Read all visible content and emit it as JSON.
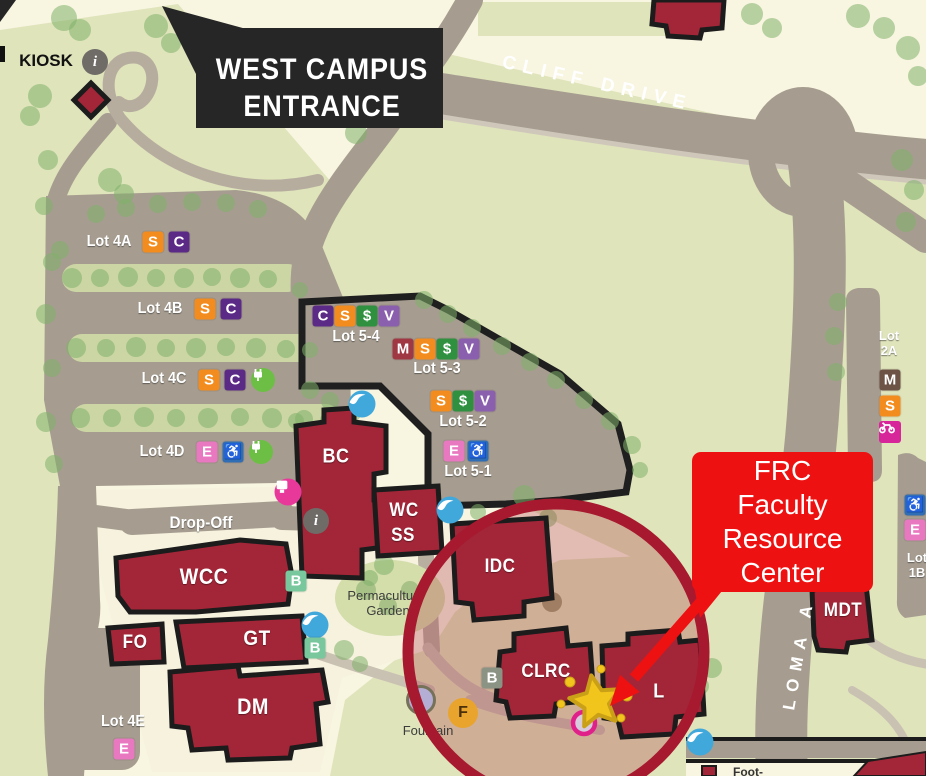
{
  "map": {
    "title_banner": {
      "line1": "WEST CAMPUS",
      "line2": "ENTRANCE"
    },
    "kiosk_label": "KIOSK",
    "roads": {
      "cliff_drive": "CLIFF DRIVE",
      "loma_alta": "LOMA A"
    },
    "labels": {
      "drop_off": "Drop-Off",
      "permaculture_line1": "Permaculture",
      "permaculture_line2": "Garden",
      "fountain": "Fountain"
    },
    "buildings": [
      {
        "id": "bc",
        "label": "BC"
      },
      {
        "id": "wcss",
        "line1": "WC",
        "line2": "SS"
      },
      {
        "id": "idc",
        "label": "IDC"
      },
      {
        "id": "wcc",
        "label": "WCC"
      },
      {
        "id": "fo",
        "label": "FO"
      },
      {
        "id": "gt",
        "label": "GT"
      },
      {
        "id": "dm",
        "label": "DM"
      },
      {
        "id": "clrc",
        "label": "CLRC"
      },
      {
        "id": "l",
        "label": "L"
      },
      {
        "id": "mdt",
        "label": "MDT"
      }
    ],
    "parking_lots": [
      {
        "name": "Lot 4A",
        "badges": [
          "S",
          "C"
        ]
      },
      {
        "name": "Lot 4B",
        "badges": [
          "S",
          "C"
        ]
      },
      {
        "name": "Lot 4C",
        "badges": [
          "S",
          "C",
          "EV"
        ]
      },
      {
        "name": "Lot 4D",
        "badges": [
          "E",
          "ADA",
          "EV"
        ]
      },
      {
        "name": "Lot 4E",
        "badges": [
          "E"
        ]
      },
      {
        "name": "Lot 5-4",
        "badges": [
          "C",
          "S",
          "DOLLAR",
          "V"
        ]
      },
      {
        "name": "Lot 5-3",
        "badges": [
          "M",
          "S",
          "DOLLAR",
          "V"
        ]
      },
      {
        "name": "Lot 5-2",
        "badges": [
          "S",
          "DOLLAR",
          "V"
        ]
      },
      {
        "name": "Lot 5-1",
        "badges": [
          "E",
          "ADA"
        ]
      },
      {
        "name": "Lot 2A",
        "badges": [
          "M2",
          "S",
          "MC"
        ]
      },
      {
        "name": "Lot 1B",
        "badges": [
          "ADA",
          "E"
        ]
      }
    ],
    "lot_name_parts": {
      "lot2a_line1": "Lot",
      "lot2a_line2": "2A",
      "lot1b_line1": "Lot",
      "lot1b_line2": "1B"
    },
    "badge_glyphs": {
      "S": "S",
      "C": "C",
      "DOLLAR": "$",
      "V": "V",
      "M": "M",
      "M2": "M",
      "E": "E",
      "ADA": "♿",
      "B": "B",
      "F": "F",
      "INFO": "i"
    },
    "badge_colors": {
      "S": "#f28c1e",
      "C": "#5b2a86",
      "DOLLAR": "#2f9140",
      "V": "#8a5fae",
      "M": "#a03844",
      "M2": "#6d5246",
      "E": "#e878c0",
      "ADA": "#2f6db4",
      "B": "#79c79d",
      "B_DIM": "#8b9484",
      "F": "#e9a42e",
      "EV": "#6cbf44",
      "MC": "#d6269a",
      "INFO": "#6f6b67",
      "BIRD": "#41a8db",
      "PINK": "#e8399b"
    },
    "colors": {
      "building": "#a32638",
      "road": "#a69d90",
      "field": "#dfe4bb",
      "highlight_ring": "#a6192e",
      "annotation": "#ee1111",
      "tree": "#7fb069"
    },
    "annotation": {
      "lines": [
        "FRC",
        "Faculty",
        "Resource",
        "Center"
      ]
    },
    "legend": {
      "footpath_label": "Foot-"
    }
  }
}
